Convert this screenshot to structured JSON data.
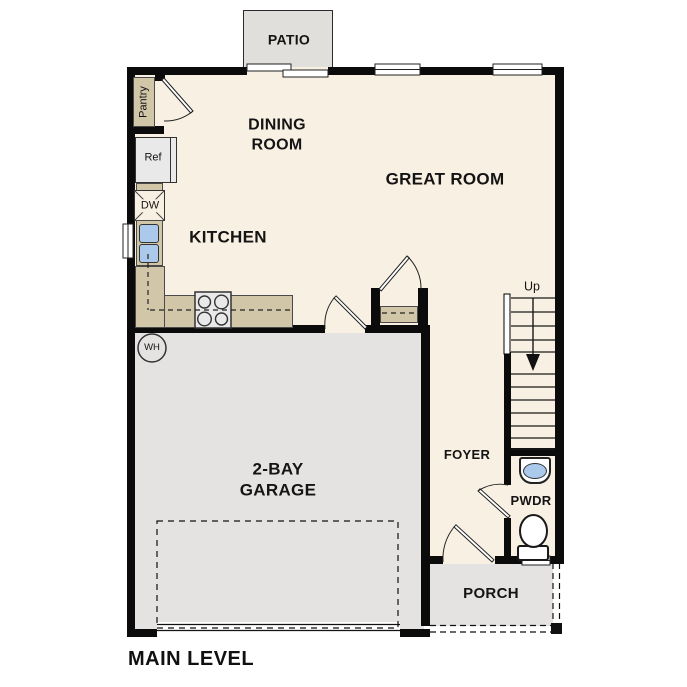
{
  "plan": {
    "title": "MAIN LEVEL",
    "rooms": {
      "patio": "PATIO",
      "dining_room": "DINING\nROOM",
      "great_room": "GREAT ROOM",
      "kitchen": "KITCHEN",
      "garage": "2-BAY\nGARAGE",
      "foyer": "FOYER",
      "powder": "PWDR",
      "porch": "PORCH",
      "pantry": "Pantry"
    },
    "annotations": {
      "refrigerator": "Ref",
      "dishwasher": "DW",
      "water_heater": "WH",
      "stairs_direction": "Up"
    },
    "colors": {
      "floor": "#F8F0E2",
      "garage_floor": "#E4E3E1",
      "patio_floor": "#E0DFDC",
      "counter": "#D2C6A9",
      "sink_blue": "#ABC9EA",
      "wall": "#0B0B0B"
    }
  }
}
